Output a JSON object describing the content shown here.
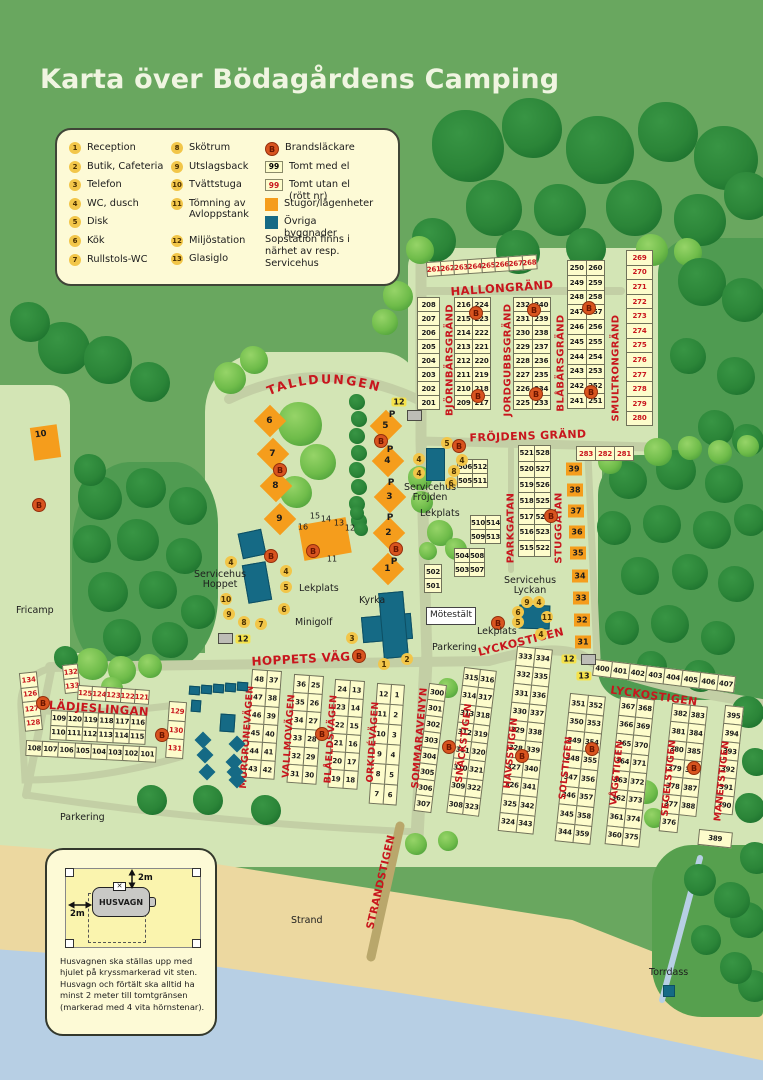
{
  "title": "Karta över Bödagårdens Camping",
  "legend": {
    "col1": [
      {
        "num": "1",
        "label": "Reception"
      },
      {
        "num": "2",
        "label": "Butik, Cafeteria"
      },
      {
        "num": "3",
        "label": "Telefon"
      },
      {
        "num": "4",
        "label": "WC, dusch"
      },
      {
        "num": "5",
        "label": "Disk"
      },
      {
        "num": "6",
        "label": "Kök"
      },
      {
        "num": "7",
        "label": "Rullstols-WC"
      }
    ],
    "col2": [
      {
        "num": "8",
        "label": "Skötrum"
      },
      {
        "num": "9",
        "label": "Utslagsback"
      },
      {
        "num": "10",
        "label": "Tvättstuga"
      },
      {
        "num": "11",
        "label": "Tömning av Avloppstank"
      },
      {
        "num": "12",
        "label": "Miljöstation"
      },
      {
        "num": "13",
        "label": "Glasiglo"
      }
    ],
    "col3": [
      {
        "sym": "fire",
        "mark": "B",
        "label": "Brandsläckare"
      },
      {
        "sym": "el",
        "mark": "99",
        "label": "Tomt med el"
      },
      {
        "sym": "noel",
        "mark": "99",
        "label": "Tomt utan el (rött nr)"
      },
      {
        "sym": "stuga",
        "mark": "",
        "label": "Stugor/lägenheter"
      },
      {
        "sym": "building",
        "mark": "",
        "label": "Övriga byggnader"
      }
    ],
    "note": "Sopstation finns i närhet av resp. Servicehus"
  },
  "colors": {
    "stuga_orange": "#f59d1c",
    "building_teal": "#156a85",
    "plot_red": "#c8161d",
    "fire_orange": "#d8541f",
    "plot_yellow": "#fdfccb"
  },
  "map": {
    "streets": {
      "hallongrand": "HALLONGRÄND",
      "bjornbarsgrand": "BJÖRNBÄRSGRÄND",
      "jordgubbsgrand": "JORDGUBBSGRÄND",
      "blabarsgrand": "BLÅBÄRSGRÄND",
      "smultrongrand": "SMULTRONGRÄND",
      "frojdens_grand": "FRÖJDENS GRÄND",
      "talldungen": "TALLDUNGEN",
      "parkgatan": "PARKGATAN",
      "stuggatan": "STUGGATAN",
      "hoppets_vag": "HOPPETS VÄG",
      "lyckostigen": "LYCKOSTIGEN",
      "gladjeslingan": "GLÄDJESLINGAN",
      "murgronevagen": "MURGRÖNEVÄGEN",
      "vallmovagen": "VALLMOVÄGEN",
      "blaeldsvagen": "BLÅELDSVÄGEN",
      "orkidevagen": "ORKIDÉVÄGEN",
      "sommaravenyn": "SOMMARAVENYN",
      "snackstigen": "SNÄCKSTIGEN",
      "havsstigen": "HAVSSTIGEN",
      "solstigen": "SOLSTIGEN",
      "vagstigen": "VÅGSTIGEN",
      "segelstigen": "SEGELSTIGEN",
      "manetstigen": "MANETSTIGEN",
      "strandstigen": "STRANDSTIGEN"
    },
    "plot_blocks": {
      "hallongrand_row": [
        [
          "261",
          "262",
          "263",
          "264",
          "265",
          "266",
          "267",
          "268"
        ]
      ],
      "bjorn_left": [
        [
          "208"
        ],
        [
          "207"
        ],
        [
          "206"
        ],
        [
          "205"
        ],
        [
          "204"
        ],
        [
          "203"
        ],
        [
          "202"
        ],
        [
          "201"
        ]
      ],
      "bjorn_pairs": [
        [
          "216",
          "224"
        ],
        [
          "215",
          "223"
        ],
        [
          "214",
          "222"
        ],
        [
          "213",
          "221"
        ],
        [
          "212",
          "220"
        ],
        [
          "211",
          "219"
        ],
        [
          "210",
          "218"
        ],
        [
          "209",
          "217"
        ]
      ],
      "jordgubb_pairs": [
        [
          "232",
          "240"
        ],
        [
          "231",
          "239"
        ],
        [
          "230",
          "238"
        ],
        [
          "229",
          "237"
        ],
        [
          "228",
          "236"
        ],
        [
          "227",
          "235"
        ],
        [
          "226",
          "234"
        ],
        [
          "225",
          "233"
        ]
      ],
      "blabar_pairs": [
        [
          "250",
          "260"
        ],
        [
          "249",
          "259"
        ],
        [
          "248",
          "258"
        ],
        [
          "247",
          "257"
        ],
        [
          "246",
          "256"
        ],
        [
          "245",
          "255"
        ],
        [
          "244",
          "254"
        ],
        [
          "243",
          "253"
        ],
        [
          "242",
          "252"
        ],
        [
          "241",
          "251"
        ]
      ],
      "smultron_col": [
        [
          "269"
        ],
        [
          "270"
        ],
        [
          "271"
        ],
        [
          "272"
        ],
        [
          "273"
        ],
        [
          "274"
        ],
        [
          "275"
        ],
        [
          "276"
        ],
        [
          "277"
        ],
        [
          "278"
        ],
        [
          "279"
        ],
        [
          "280"
        ]
      ],
      "row_283": [
        [
          "283",
          "282",
          "281"
        ]
      ],
      "frojden_pairs": [
        [
          "506",
          "512"
        ],
        [
          "505",
          "511"
        ]
      ],
      "parkgatan_pairs": [
        [
          "521",
          "528"
        ],
        [
          "520",
          "527"
        ],
        [
          "519",
          "526"
        ],
        [
          "518",
          "525"
        ],
        [
          "517",
          "524"
        ],
        [
          "516",
          "523"
        ],
        [
          "515",
          "522"
        ]
      ],
      "mid_pairs_a": [
        [
          "510",
          "514"
        ],
        [
          "509",
          "513"
        ]
      ],
      "mid_pairs_b": [
        [
          "504",
          "508"
        ],
        [
          "503",
          "507"
        ]
      ],
      "col_501": [
        [
          "502"
        ],
        [
          "501"
        ]
      ],
      "glad_left_red": [
        [
          "134"
        ],
        [
          "126"
        ],
        [
          "127"
        ],
        [
          "128"
        ]
      ],
      "glad_top_red_a": [
        [
          "132"
        ],
        [
          "133"
        ]
      ],
      "glad_top_red_b": [
        [
          "125",
          "124",
          "123",
          "122",
          "121"
        ]
      ],
      "glad_rows": [
        [
          "109",
          "120",
          "119",
          "118",
          "117",
          "116"
        ],
        [
          "110",
          "111",
          "112",
          "113",
          "114",
          "115"
        ]
      ],
      "glad_bottom": [
        [
          "108",
          "107",
          "106",
          "105",
          "104",
          "103",
          "102",
          "101"
        ]
      ],
      "glad_right_red": [
        [
          "129"
        ],
        [
          "130"
        ],
        [
          "131"
        ]
      ],
      "murgron_pairs": [
        [
          "48",
          "37"
        ],
        [
          "47",
          "38"
        ],
        [
          "46",
          "39"
        ],
        [
          "45",
          "40"
        ],
        [
          "44",
          "41"
        ],
        [
          "43",
          "42"
        ]
      ],
      "vallmo_pairs": [
        [
          "36",
          "25"
        ],
        [
          "35",
          "26"
        ],
        [
          "34",
          "27"
        ],
        [
          "33",
          "28"
        ],
        [
          "32",
          "29"
        ],
        [
          "31",
          "30"
        ]
      ],
      "blaeld_pairs": [
        [
          "24",
          "13"
        ],
        [
          "23",
          "14"
        ],
        [
          "22",
          "15"
        ],
        [
          "21",
          "16"
        ],
        [
          "20",
          "17"
        ],
        [
          "19",
          "18"
        ]
      ],
      "orkide_pairs": [
        [
          "12",
          "1"
        ],
        [
          "11",
          "2"
        ],
        [
          "10",
          "3"
        ],
        [
          "9",
          "4"
        ],
        [
          "8",
          "5"
        ],
        [
          "7",
          "6"
        ]
      ],
      "snack_col": [
        [
          "300"
        ],
        [
          "301"
        ],
        [
          "302"
        ],
        [
          "303"
        ],
        [
          "304"
        ],
        [
          "305"
        ],
        [
          "306"
        ],
        [
          "307"
        ]
      ],
      "snack_pairs": [
        [
          "315",
          "316"
        ],
        [
          "314",
          "317"
        ],
        [
          "313",
          "318"
        ],
        [
          "312",
          "319"
        ],
        [
          "311",
          "320"
        ],
        [
          "310",
          "321"
        ],
        [
          "309",
          "322"
        ],
        [
          "308",
          "323"
        ]
      ],
      "lycko_row": [
        [
          "400",
          "401",
          "402",
          "403",
          "404",
          "405",
          "406",
          "407"
        ]
      ],
      "havs_pairs": [
        [
          "333",
          "334"
        ],
        [
          "332",
          "335"
        ],
        [
          "331",
          "336"
        ],
        [
          "330",
          "337"
        ],
        [
          "329",
          "338"
        ],
        [
          "328",
          "339"
        ],
        [
          "327",
          "340"
        ],
        [
          "326",
          "341"
        ],
        [
          "325",
          "342"
        ],
        [
          "324",
          "343"
        ]
      ],
      "sol_pairs": [
        [
          "351",
          "352"
        ],
        [
          "350",
          "353"
        ],
        [
          "349",
          "354"
        ],
        [
          "348",
          "355"
        ],
        [
          "347",
          "356"
        ],
        [
          "346",
          "357"
        ],
        [
          "345",
          "358"
        ],
        [
          "344",
          "359"
        ]
      ],
      "vag_pairs": [
        [
          "367",
          "368"
        ],
        [
          "366",
          "369"
        ],
        [
          "365",
          "370"
        ],
        [
          "364",
          "371"
        ],
        [
          "363",
          "372"
        ],
        [
          "362",
          "373"
        ],
        [
          "361",
          "374"
        ],
        [
          "360",
          "375"
        ]
      ],
      "segel_pairs": [
        [
          "382",
          "383"
        ],
        [
          "381",
          "384"
        ],
        [
          "380",
          "385"
        ],
        [
          "379",
          "386"
        ],
        [
          "378",
          "387"
        ],
        [
          "377",
          "388"
        ],
        [
          "376",
          ""
        ]
      ],
      "manet_col": [
        [
          "395"
        ],
        [
          "394"
        ],
        [
          "393"
        ],
        [
          "392"
        ],
        [
          "391"
        ],
        [
          "390"
        ]
      ],
      "cell_389": [
        [
          "389"
        ]
      ]
    },
    "stugor": {
      "talldungen_left": [
        "6",
        "7",
        "8",
        "9"
      ],
      "talldungen_right": [
        "5",
        "4",
        "3",
        "2",
        "1"
      ],
      "stuggatan_boxes": [
        "39",
        "38",
        "37",
        "36",
        "35",
        "34",
        "33",
        "32",
        "31"
      ],
      "tvattstuga": "10",
      "storstuga": [
        "16",
        "15",
        "14",
        "13",
        "12",
        "11"
      ]
    },
    "badges": {
      "frojden": [
        "5",
        "4",
        "4",
        "4",
        "8",
        "6"
      ],
      "hoppet": [
        "4",
        "4",
        "5",
        "10",
        "9",
        "8",
        "7",
        "6"
      ],
      "lyckan": [
        "9",
        "4",
        "6",
        "5",
        "11",
        "4"
      ],
      "kyrka": [
        "3",
        "1",
        "2"
      ]
    },
    "markers": {
      "fire": "B",
      "parking": "P",
      "miljostation": "12",
      "glasiglo": "13"
    },
    "labels": {
      "servicehus_frojden": "Servicehus Fröjden",
      "servicehus_hoppet": "Servicehus Hoppet",
      "servicehus_lyckan": "Servicehus Lyckan",
      "lekplats": "Lekplats",
      "minigolf": "Minigolf",
      "kyrka": "Kyrka",
      "motestalt": "Mötestält",
      "parkering": "Parkering",
      "fricamp": "Fricamp",
      "strand": "Strand",
      "torrdass": "Torrdass"
    }
  },
  "inset": {
    "caravan": "HUSVAGN",
    "dist_v": "2m",
    "dist_h": "2m",
    "cross": "✕",
    "text": "Husvagnen ska ställas upp med hjulet på kryssmarkerad vit sten. Husvagn och förtält ska alltid ha minst 2 meter till tomtgränsen (markerad med 4 vita hörnstenar)."
  }
}
